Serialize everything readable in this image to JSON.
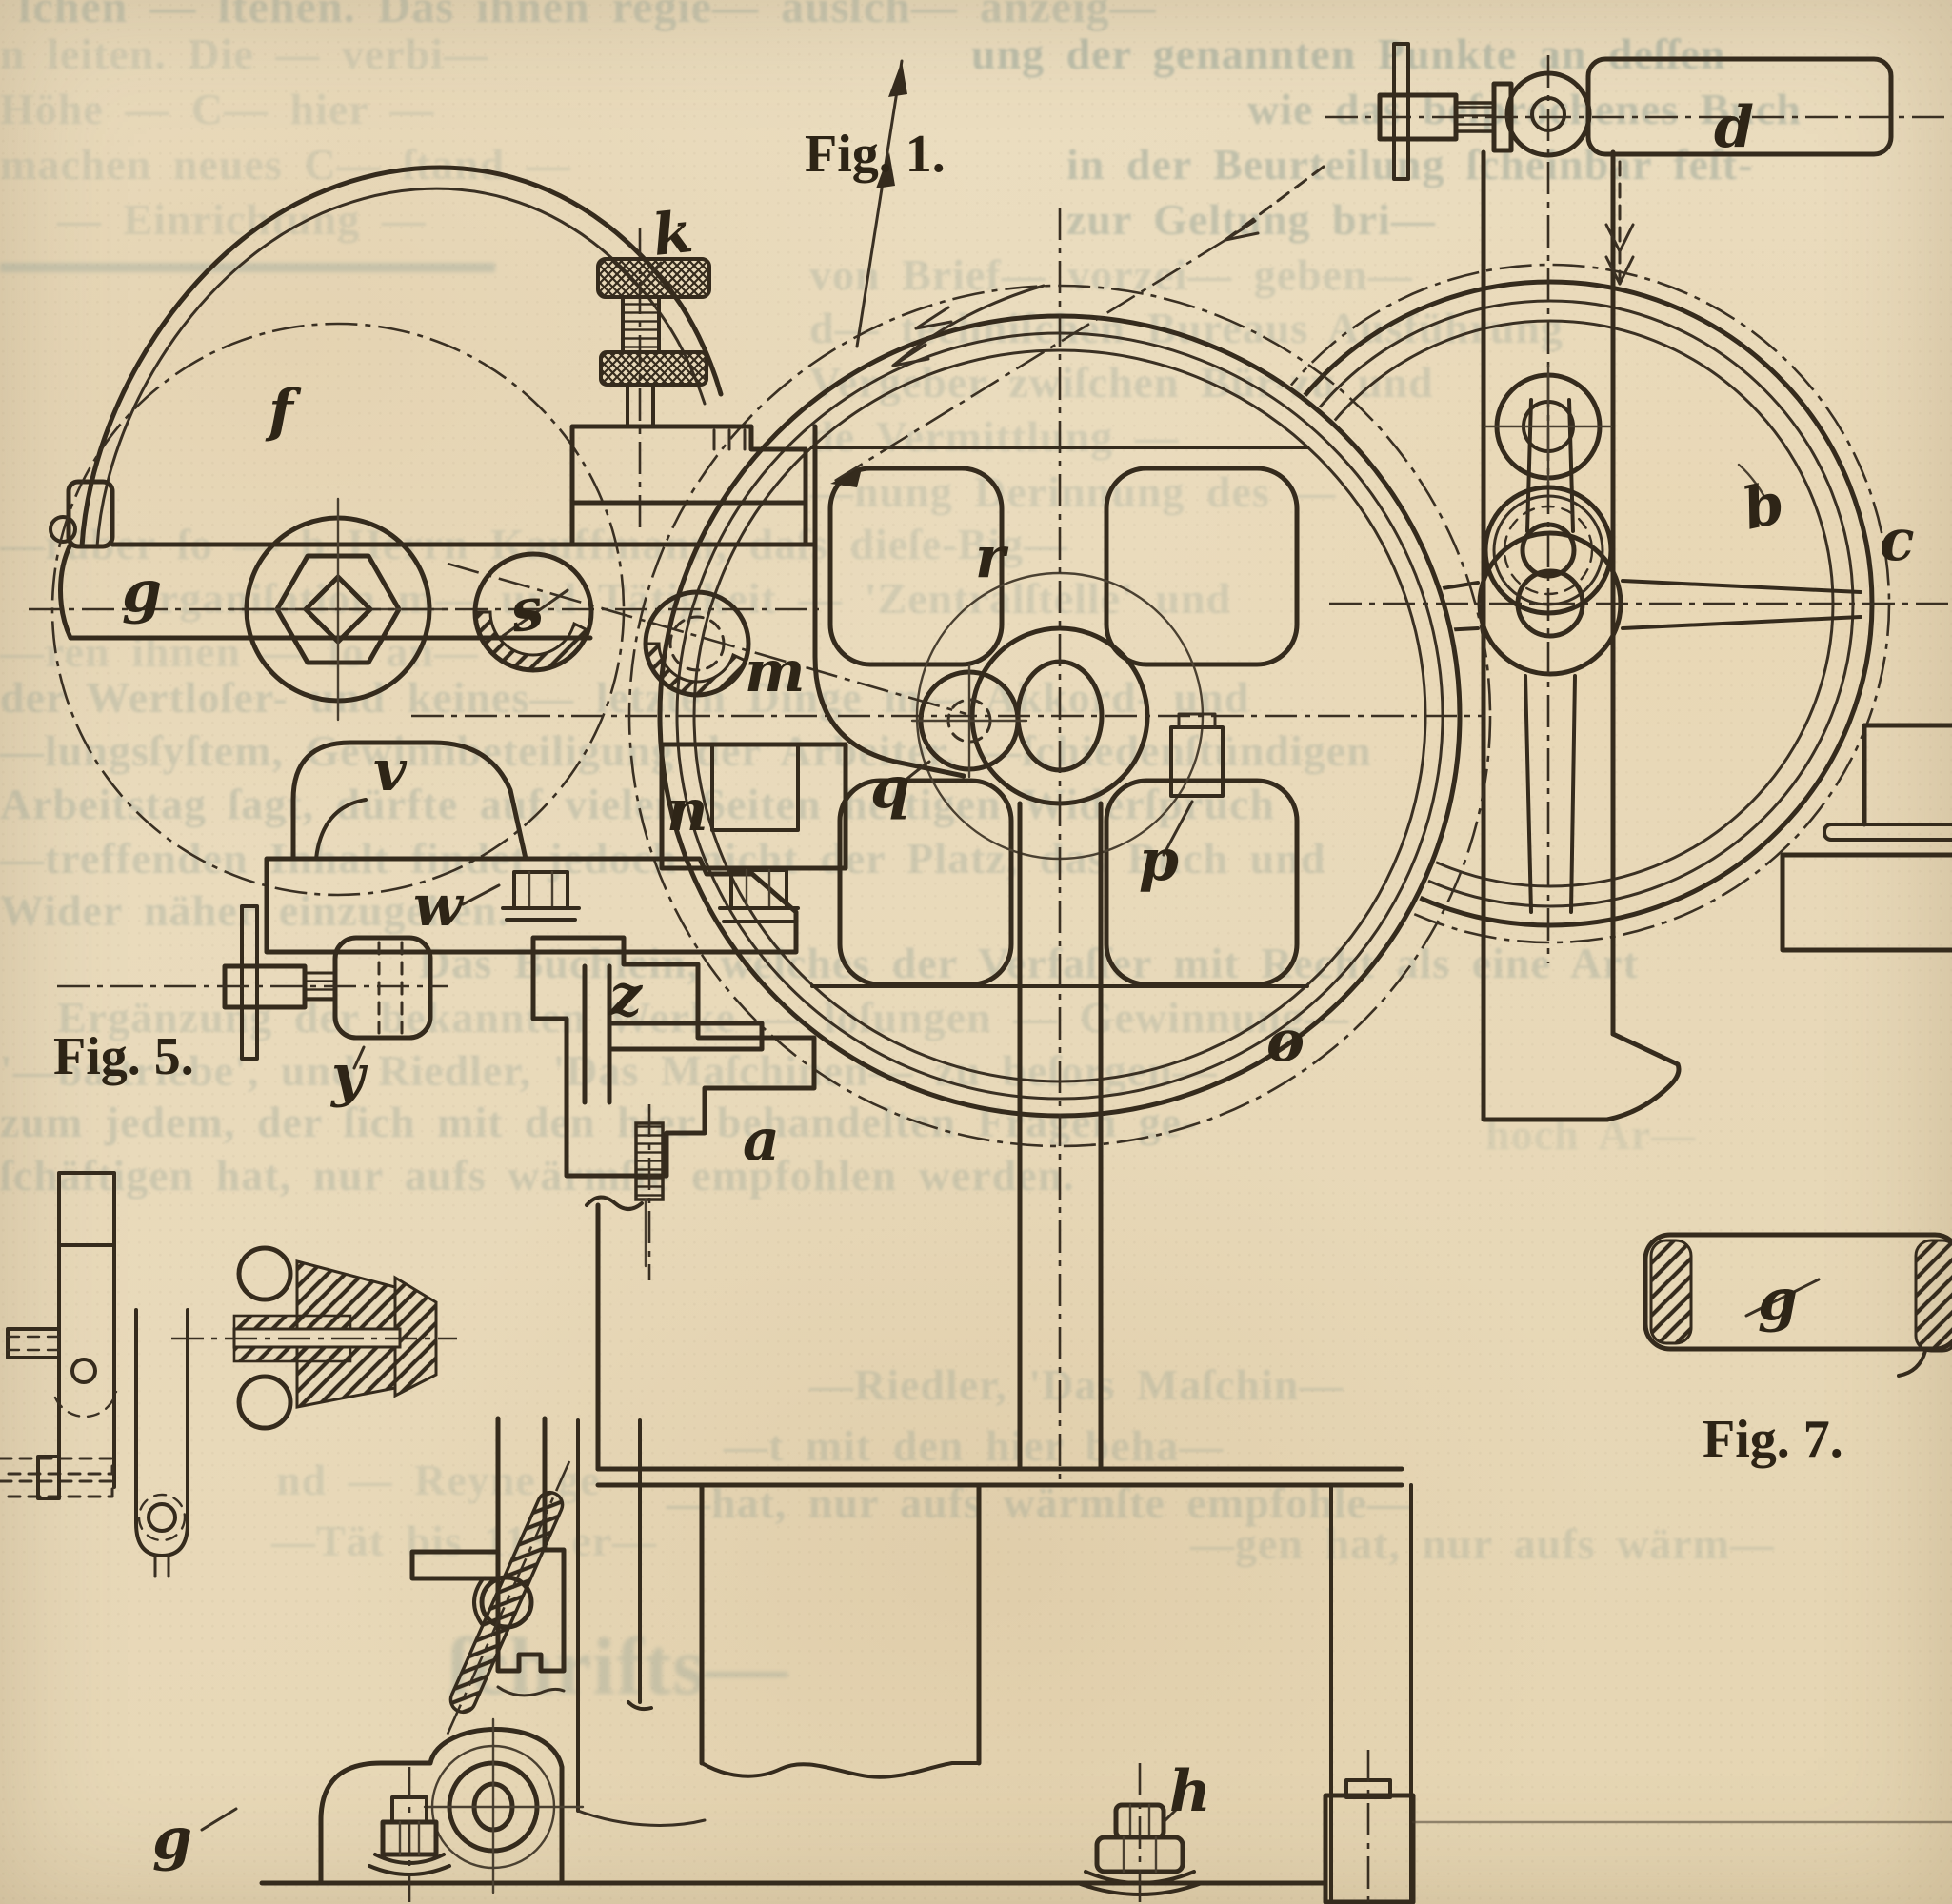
{
  "palette": {
    "paper": "#e9dabb",
    "ink": "#352b1d",
    "ghost_text": "#7e938b"
  },
  "captions": {
    "fig1": "Fig. 1.",
    "fig5": "Fig. 5.",
    "fig7": "Fig. 7."
  },
  "labels": {
    "k": "k",
    "f": "f",
    "g_arm": "g",
    "s": "s",
    "m": "m",
    "n": "n",
    "v": "v",
    "w": "w",
    "y": "y",
    "z": "z",
    "a": "a",
    "q": "q",
    "p": "p",
    "r": "r",
    "o": "o",
    "b": "b",
    "c": "c",
    "d": "d",
    "h": "h",
    "g_roller": "g",
    "g_bottom": "g"
  },
  "ghost_lines": [
    {
      "text": "ſchen — ſtehen. Das ihnen regie— ausſch— anzeig—"
    },
    {
      "text": "n leiten. Die — verbi—"
    },
    {
      "text": "ung der genannten Punkte an deſſen"
    },
    {
      "text": "Höhe — C— hier —"
    },
    {
      "text": "wie das beſprochenes Buch"
    },
    {
      "text": "machen neues C— ſtand —"
    },
    {
      "text": "in der Beurteilung ſcheinbar feſt-"
    },
    {
      "text": "— Einrichtung —"
    },
    {
      "text": "zur Geltung bri—"
    },
    {
      "text": "von Brief— vorzei— geben—"
    },
    {
      "text": "d— techniſchen Bureaus Ausführung"
    },
    {
      "text": "Vergeber zwiſchen Bür-zu und"
    },
    {
      "text": "de Vermittlung —"
    },
    {
      "text": "—nung Derinnung des —"
    },
    {
      "text": "—rüber ſo — b Herrn Kauffmann, daſs dieſe-Big—"
    },
    {
      "text": "Organiſation m— und Tätigkeit — 'Zentralſtelle' und"
    },
    {
      "text": "—ren ihnen — ſo an—"
    },
    {
      "text": "der Wertloſer- und keines— letzten Dinge m— Akkord- und"
    },
    {
      "text": "—lungsſyſtem, Gewinnbeteiligung der Arbeiter, —ſchiedenſtündigen"
    },
    {
      "text": "Arbeitstag ſagt, dürfte auf vielen Seiten heftigen Widerſpruch"
    },
    {
      "text": "—treffenden Inhalt findet jedoch nicht der Platz, das Buch und"
    },
    {
      "text": "Wider näher einzugehen."
    },
    {
      "text": "Das Büchlein, welches der Verfaſſer mit Recht als eine Art"
    },
    {
      "text": "Ergänzung der bekannten Werke — loſungen — Gewinnung—"
    },
    {
      "text": "'—baltriebe', und Riedler, 'Das Maſchinen— zu beſorgen—"
    },
    {
      "text": "zum jedem, der ſich mit den hier behandelten Fragen ge-"
    },
    {
      "text": "ſchäftigen hat, nur aufs wärmſte empfohlen werden."
    },
    {
      "text": "—Riedler, 'Das Maſchin—"
    },
    {
      "text": "—t mit den hier beha—"
    },
    {
      "text": "—hat, nur aufs wärmſte empfohle—"
    },
    {
      "text": "—gen hat, nur aufs wärm—"
    },
    {
      "text": "nd — Reyne ge—"
    },
    {
      "text": "—Tät bis 113 er—"
    },
    {
      "text": "ſchrifts—"
    },
    {
      "text": "hoch Ar—"
    }
  ]
}
